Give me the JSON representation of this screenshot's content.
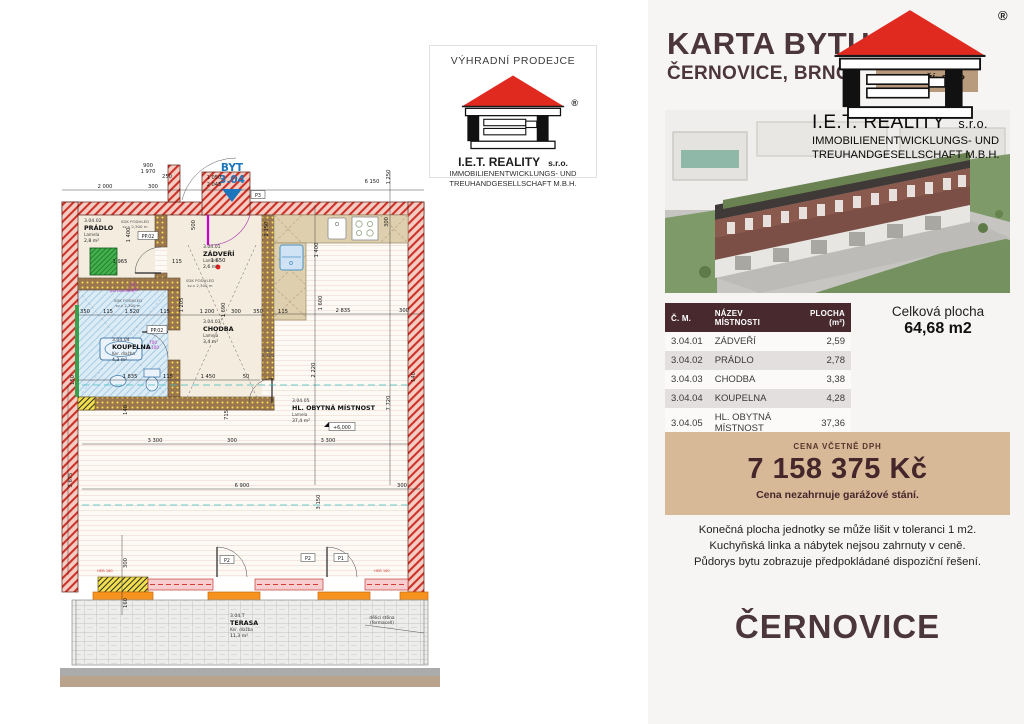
{
  "header": {
    "title": "KARTA BYTU",
    "subtitle": "ČERNOVICE, BRNO",
    "floor_badge": "PODLAŽÍ: 3.NP"
  },
  "brand": {
    "name": "I.E.T. REALITY",
    "suffix": "s.r.o.",
    "line2": "IMMOBILIENENTWICKLUNGS- UND",
    "line3": "TREUHANDGESELLSCHAFT M.B.H.",
    "registered": "®"
  },
  "exclusive": {
    "label": "VÝHRADNÍ PRODEJCE"
  },
  "table": {
    "headers": [
      "Č. M.",
      "NÁZEV MÍSTNOSTI",
      "PLOCHA (m²)"
    ],
    "rows": [
      [
        "3.04.01",
        "ZÁDVEŘÍ",
        "2,59"
      ],
      [
        "3.04.02",
        "PRÁDLO",
        "2,78"
      ],
      [
        "3.04.03",
        "CHODBA",
        "3,38"
      ],
      [
        "3.04.04",
        "KOUPELNA",
        "4,28"
      ],
      [
        "3.04.05",
        "HL. OBYTNÁ MÍSTNOST",
        "37,36"
      ],
      [
        "3.04.T",
        "TERASA",
        "11,93"
      ]
    ]
  },
  "total": {
    "label": "Celková plocha",
    "value": "64,68 m2"
  },
  "price": {
    "label": "CENA VČETNĚ DPH",
    "value": "7 158 375 Kč",
    "note": "Cena nezahrnuje garážové stání."
  },
  "disclaimer": [
    "Konečná plocha jednotky se může lišit v toleranci 1 m2.",
    "Kuchyňská linka a nábytek nejsou zahrnuty v ceně.",
    "Půdorys bytu zobrazuje předpokládané dispoziční řešení."
  ],
  "footer": {
    "location": "ČERNOVICE"
  },
  "plan": {
    "unit_label": "BYT",
    "unit_number": "3.04",
    "elevation": "+6,000",
    "rooms": [
      {
        "id": "3.04.02",
        "name": "PRÁDLO",
        "sub": "Lamela",
        "area": "2,8 m²",
        "x": 24,
        "y": 67
      },
      {
        "id": "3.04.01",
        "name": "ZÁDVEŘÍ",
        "sub": "Lamela",
        "area": "2,6 m²",
        "x": 143,
        "y": 93
      },
      {
        "id": "3.04.03",
        "name": "CHODBA",
        "sub": "Lamela",
        "area": "3,4 m²",
        "x": 143,
        "y": 168
      },
      {
        "id": "3.04.04",
        "name": "KOUPELNA",
        "sub": "Ker. dlažba",
        "area": "4,3 m²",
        "x": 52,
        "y": 186
      },
      {
        "id": "3.04.05",
        "name": "HL. OBYTNÁ MÍSTNOST",
        "sub": "Lamela",
        "area": "37,4 m²",
        "x": 232,
        "y": 247
      },
      {
        "id": "3.04.T",
        "name": "TERASA",
        "sub": "Ker. dlažba",
        "area": "11,3 m²",
        "x": 170,
        "y": 462
      }
    ],
    "dims": [
      {
        "t": "2 000",
        "x": 45,
        "y": 33
      },
      {
        "t": "300",
        "x": 93,
        "y": 33
      },
      {
        "t": "900",
        "x": 88,
        "y": 12
      },
      {
        "t": "1 970",
        "x": 88,
        "y": 18
      },
      {
        "t": "250",
        "x": 107,
        "y": 23
      },
      {
        "t": "1 050",
        "x": 154,
        "y": 24
      },
      {
        "t": "2 045",
        "x": 154,
        "y": 31
      },
      {
        "t": "6 150",
        "x": 312,
        "y": 28
      },
      {
        "t": "1 250",
        "x": 330,
        "y": 22,
        "r": 1
      },
      {
        "t": "1 400",
        "x": 258,
        "y": 95,
        "r": 1
      },
      {
        "t": "300",
        "x": 328,
        "y": 67,
        "r": 1
      },
      {
        "t": "1 600",
        "x": 262,
        "y": 148,
        "r": 1
      },
      {
        "t": "500",
        "x": 135,
        "y": 70,
        "r": 1
      },
      {
        "t": "1 205",
        "x": 123,
        "y": 150,
        "r": 1
      },
      {
        "t": "1 690",
        "x": 165,
        "y": 155,
        "r": 1
      },
      {
        "t": "2 150",
        "x": 208,
        "y": 74,
        "r": 1
      },
      {
        "t": "350",
        "x": 25,
        "y": 158
      },
      {
        "t": "115",
        "x": 48,
        "y": 158
      },
      {
        "t": "1 520",
        "x": 72,
        "y": 158
      },
      {
        "t": "115",
        "x": 105,
        "y": 158
      },
      {
        "t": "1 200",
        "x": 147,
        "y": 158
      },
      {
        "t": "300",
        "x": 176,
        "y": 158
      },
      {
        "t": "350",
        "x": 198,
        "y": 158
      },
      {
        "t": "115",
        "x": 223,
        "y": 158
      },
      {
        "t": "2 835",
        "x": 283,
        "y": 157
      },
      {
        "t": "300",
        "x": 344,
        "y": 157
      },
      {
        "t": "1 835",
        "x": 70,
        "y": 223
      },
      {
        "t": "115",
        "x": 108,
        "y": 223
      },
      {
        "t": "1 450",
        "x": 148,
        "y": 223
      },
      {
        "t": "50",
        "x": 186,
        "y": 223
      },
      {
        "t": "3 300",
        "x": 95,
        "y": 287
      },
      {
        "t": "300",
        "x": 172,
        "y": 287
      },
      {
        "t": "3 300",
        "x": 268,
        "y": 287
      },
      {
        "t": "6 900",
        "x": 182,
        "y": 332
      },
      {
        "t": "300",
        "x": 342,
        "y": 332
      },
      {
        "t": "2 220",
        "x": 255,
        "y": 215,
        "r": 1
      },
      {
        "t": "7 720",
        "x": 330,
        "y": 248,
        "r": 1
      },
      {
        "t": "3 150",
        "x": 260,
        "y": 347,
        "r": 1
      },
      {
        "t": "140",
        "x": 67,
        "y": 255,
        "r": 1
      },
      {
        "t": "715",
        "x": 168,
        "y": 260,
        "r": 1
      },
      {
        "t": "150",
        "x": 14,
        "y": 225,
        "r": 1
      },
      {
        "t": "1 400",
        "x": 70,
        "y": 80,
        "r": 1
      },
      {
        "t": "1 965",
        "x": 60,
        "y": 108
      },
      {
        "t": "115",
        "x": 117,
        "y": 108
      },
      {
        "t": "1 650",
        "x": 158,
        "y": 107
      },
      {
        "t": "300",
        "x": 67,
        "y": 408,
        "r": 1
      },
      {
        "t": "160",
        "x": 67,
        "y": 448,
        "r": 1
      },
      {
        "t": "3 675",
        "x": 12,
        "y": 325,
        "r": 1
      },
      {
        "t": "140",
        "x": 355,
        "y": 222,
        "r": 1
      }
    ],
    "notes": [
      {
        "lines": [
          "SDK PODHLED",
          "sv.v 2,300 m"
        ],
        "x": 75,
        "y": 68,
        "s": 3.9,
        "c": "#555"
      },
      {
        "lines": [
          "SDK PODHLED",
          "sv.v 2,300 m"
        ],
        "x": 140,
        "y": 127,
        "s": 3.9,
        "c": "#555"
      },
      {
        "lines": [
          "SDK PODHLED",
          "sv.v 2,300 m"
        ],
        "x": 68,
        "y": 147,
        "s": 3.9,
        "c": "#555"
      },
      {
        "lines": [
          "(po podhled)"
        ],
        "x": 62,
        "y": 137,
        "s": 3.9,
        "c": "#b03ab0"
      },
      {
        "lines": [
          "700",
          "2 100"
        ],
        "x": 93,
        "y": 189,
        "s": 4.2,
        "c": "#b03ab0"
      },
      {
        "lines": [
          "700",
          "2 100"
        ],
        "x": 73,
        "y": 131,
        "s": 4.2,
        "c": "#b03ab0"
      },
      {
        "lines": [
          "800",
          "2 100"
        ],
        "x": 208,
        "y": 197,
        "s": 4.2,
        "c": "#555"
      },
      {
        "lines": [
          "dělicí stěna",
          "(fermacell)"
        ],
        "x": 322,
        "y": 464,
        "s": 4.4,
        "c": "#333"
      },
      {
        "lines": [
          "HEB 160"
        ],
        "x": 45,
        "y": 417,
        "s": 3.6,
        "c": "#d03c30"
      },
      {
        "lines": [
          "HEB 160"
        ],
        "x": 322,
        "y": 417,
        "s": 3.6,
        "c": "#d03c30"
      }
    ],
    "markers": [
      {
        "t": "P3",
        "x": 198,
        "y": 41,
        "w": 14
      },
      {
        "t": "P2",
        "x": 167,
        "y": 406,
        "w": 14
      },
      {
        "t": "P2",
        "x": 248,
        "y": 404,
        "w": 14
      },
      {
        "t": "P1",
        "x": 281,
        "y": 404,
        "w": 14
      },
      {
        "t": "PP.02",
        "x": 88,
        "y": 82,
        "w": 20
      },
      {
        "t": "PP.02",
        "x": 97,
        "y": 176,
        "w": 20
      },
      {
        "t": "+6,000",
        "x": 282,
        "y": 273,
        "w": 26,
        "flag": true
      }
    ]
  },
  "colors": {
    "accent_dark_brown": "#47292e",
    "price_box_tan": "#d7b997",
    "badge_tan": "#b89b7c",
    "logo_roof_red": "#e02a20",
    "plan_wall_red": "#cd3128",
    "unit_marker_blue": "#1b75bc"
  }
}
